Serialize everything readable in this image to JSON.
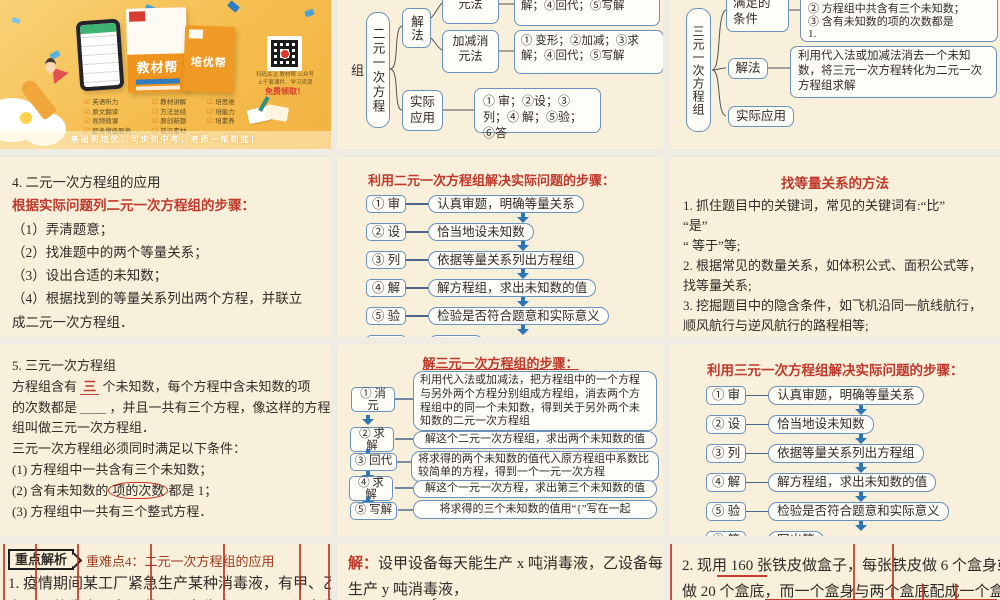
{
  "cover": {
    "book1_title": "教材帮",
    "book2_title": "培优帮",
    "qr_caption1": "扫码关注 教材帮 公众号",
    "qr_caption2": "上千套课件、学习资源",
    "qr_caption3": "免费领取！",
    "check_icon": "☑",
    "phone_list": [
      "英语听力",
      "原文翻译",
      "视频微课",
      "超多增值服务"
    ],
    "book1_list": [
      "教材讲解",
      "方法总结",
      "原创新题",
      "前沿素材"
    ],
    "book2_list": [
      "培思维",
      "培能力",
      "培素养"
    ],
    "slogan": "基础到培优，同步到中考，老师一帮到底！"
  },
  "map2": {
    "root_tail": "组",
    "root": "二元一次方程",
    "branch_solve": "解法",
    "method1": "代入消元法",
    "method1_steps": "① 变形；②代入；③求解；④回代；⑤写解",
    "method2": "加减消元法",
    "method2_steps": "① 变形；②加减；③求解；④回代；⑤写解",
    "branch_apply": "实际应用",
    "apply_steps": "① 审；②设；③列；④ 解；⑤验；⑥答"
  },
  "map3": {
    "root": "三元一次方程组",
    "cond_label": "满足的条件",
    "cond_lines": [
      "② 方程组中共含有三个未知数；",
      "③ 含有未知数的项的次数都是",
      "1."
    ],
    "solve_label": "解法",
    "solve_text": "利用代入法或加减法消去一个未知数，将三元一次方程转化为二元一次方程组求解",
    "apply_label": "实际应用"
  },
  "sec4": {
    "title": "4. 二元一次方程组的应用",
    "subtitle": "根据实际问题列二元一次方程组的步骤：",
    "lines": [
      "（1）弄清题意；",
      "（2）找准题中的两个等量关系；",
      "（3）设出合适的未知数；",
      "（4）根据找到的等量关系列出两个方程，并联立",
      "成二元一次方程组．"
    ]
  },
  "flow2": {
    "title": "利用二元一次方程组解决实际问题的步骤：",
    "steps": [
      {
        "label": "① 审",
        "desc": "认真审题，明确等量关系"
      },
      {
        "label": "② 设",
        "desc": "恰当地设未知数"
      },
      {
        "label": "③ 列",
        "desc": "依据等量关系列出方程组"
      },
      {
        "label": "④ 解",
        "desc": "解方程组，求出未知数的值"
      },
      {
        "label": "⑤ 验",
        "desc": "检验是否符合题意和实际意义"
      },
      {
        "label": "⑥ 答",
        "desc": "写出答"
      }
    ]
  },
  "methods": {
    "title": "找等量关系的方法",
    "lines": [
      "1. 抓住题目中的关键词，常见的关键词有:“比”",
      "“是”",
      "“ 等于”等;",
      "2. 根据常见的数量关系，如体积公式、面积公式等，",
      "找等量关系;",
      "3. 挖掘题目中的隐含条件，如飞机沿同一航线航行，",
      "顺风航行与逆风航行的路程相等;",
      "4. 借助列表格、画线段示意图等方法找等量关系"
    ]
  },
  "sec5": {
    "title": "5. 三元一次方程组",
    "l2a": "方程组含有 ",
    "l2b": "三",
    "l2c": " 个未知数，每个方程中含未知数的项",
    "l3": "的次数都是 ＿＿ ，并且一共有三个方程，像这样的方程",
    "l4": "组叫做三元一次方程组．",
    "l5": "三元一次方程组必须同时满足以下条件：",
    "l6": "(1) 方程组中一共含有三个未知数；",
    "l7a": "(2) 含有未知数的",
    "l7b": "项的次数",
    "l7c": "都是  1；",
    "l8": "(3) 方程组中一共有三个整式方程．"
  },
  "flow3": {
    "title": "解三元一次方程组的步骤：",
    "steps": [
      {
        "label": "① 消元",
        "desc": "利用代入法或加减法，把方程组中的一个方程与另外两个方程分别组成方程组，消去两个方程组中的同一个未知数，得到关于另外两个未知数的二元一次方程组"
      },
      {
        "label": "② 求解",
        "desc": "解这个二元一次方程组，求出两个未知数的值"
      },
      {
        "label": "③ 回代",
        "desc": "将求得的两个未知数的值代入原方程组中系数比较简单的方程，得到一个一元一次方程"
      },
      {
        "label": "④ 求解",
        "desc": "解这个一元一次方程，求出第三个未知数的值"
      },
      {
        "label": "⑤ 写解",
        "desc": "将求得的三个未知数的值用“{”写在一起"
      }
    ]
  },
  "flow3app": {
    "title": "利用三元一次方程组解决实际问题的步骤：",
    "steps": [
      {
        "label": "① 审",
        "desc": "认真审题，明确等量关系"
      },
      {
        "label": "② 设",
        "desc": "恰当地设未知数"
      },
      {
        "label": "③ 列",
        "desc": "依据等量关系列出方程组"
      },
      {
        "label": "④ 解",
        "desc": "解方程组，求出未知数的值"
      },
      {
        "label": "⑤ 验",
        "desc": "检验是否符合题意和实际意义"
      },
      {
        "label": "⑥ 答",
        "desc": "写出答"
      }
    ]
  },
  "ex1": {
    "badge": "重点解析",
    "heading": "重难点4：二元一次方程组的应用",
    "line1": "1. 疫情期间某工厂紧急生产某种消毒液，有甲、乙两",
    "line2": "套不同的生产设备．若甲设备生产 1 天，乙设备生"
  },
  "ex_solution": {
    "label": "解：",
    "line1": "设甲设备每天能生产 x 吨消毒液，乙设备每天能",
    "line2": "生产 y 吨消毒液，",
    "brace": "{",
    "eq": "x＋6y＝2 000"
  },
  "ex2": {
    "l1a": "2. 现用",
    "l1num": " 160 ",
    "l1b": "张铁皮做盒子，每张铁皮做  6  个盒身或",
    "l2a": "做  20 个盒底，",
    "l2b": "而一个盒身与两个盒底配成一个盒子，"
  }
}
